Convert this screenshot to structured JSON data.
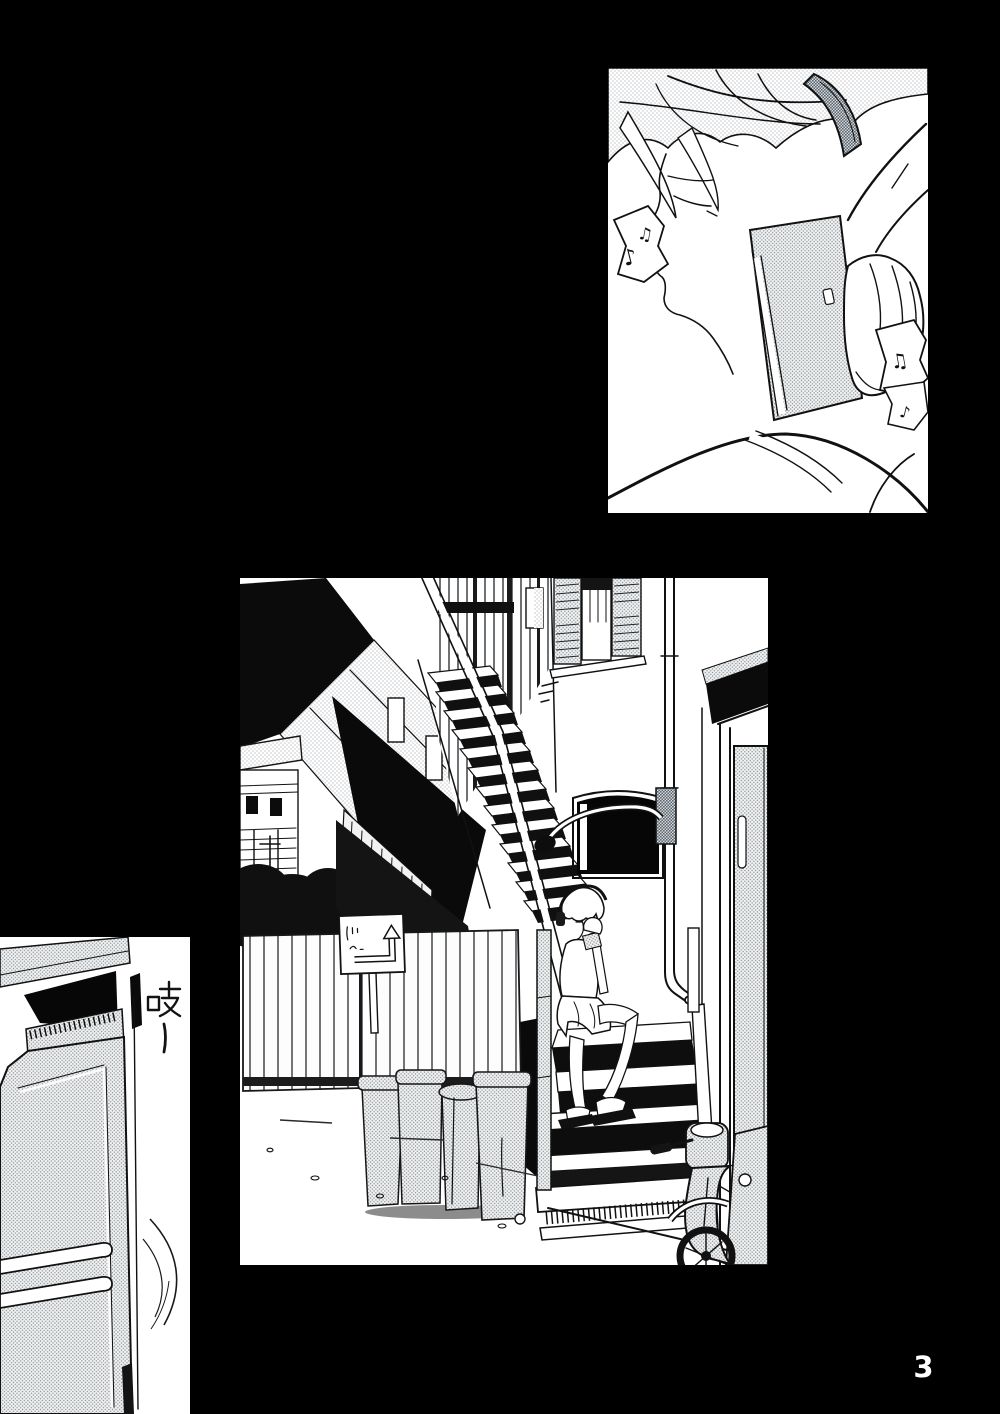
{
  "page": {
    "number": "3",
    "background_color": "#000000",
    "ink_color": "#111111",
    "paper_color": "#ffffff",
    "halftone_color": "#97a0a8"
  },
  "sfx": {
    "text": "吱ー"
  },
  "panels": {
    "closeup": {
      "label": "close-up of a person with headphones on, eyes closed, music notes around"
    },
    "alley": {
      "label": "alley with exterior staircase, person sitting on the steps wearing headphones, wooden fence, trash bins, street lamp and scooter"
    },
    "door": {
      "label": "door swinging open with a creak"
    }
  },
  "glyphs": {
    "eighth_note": "♪",
    "beamed_notes": "♫"
  }
}
